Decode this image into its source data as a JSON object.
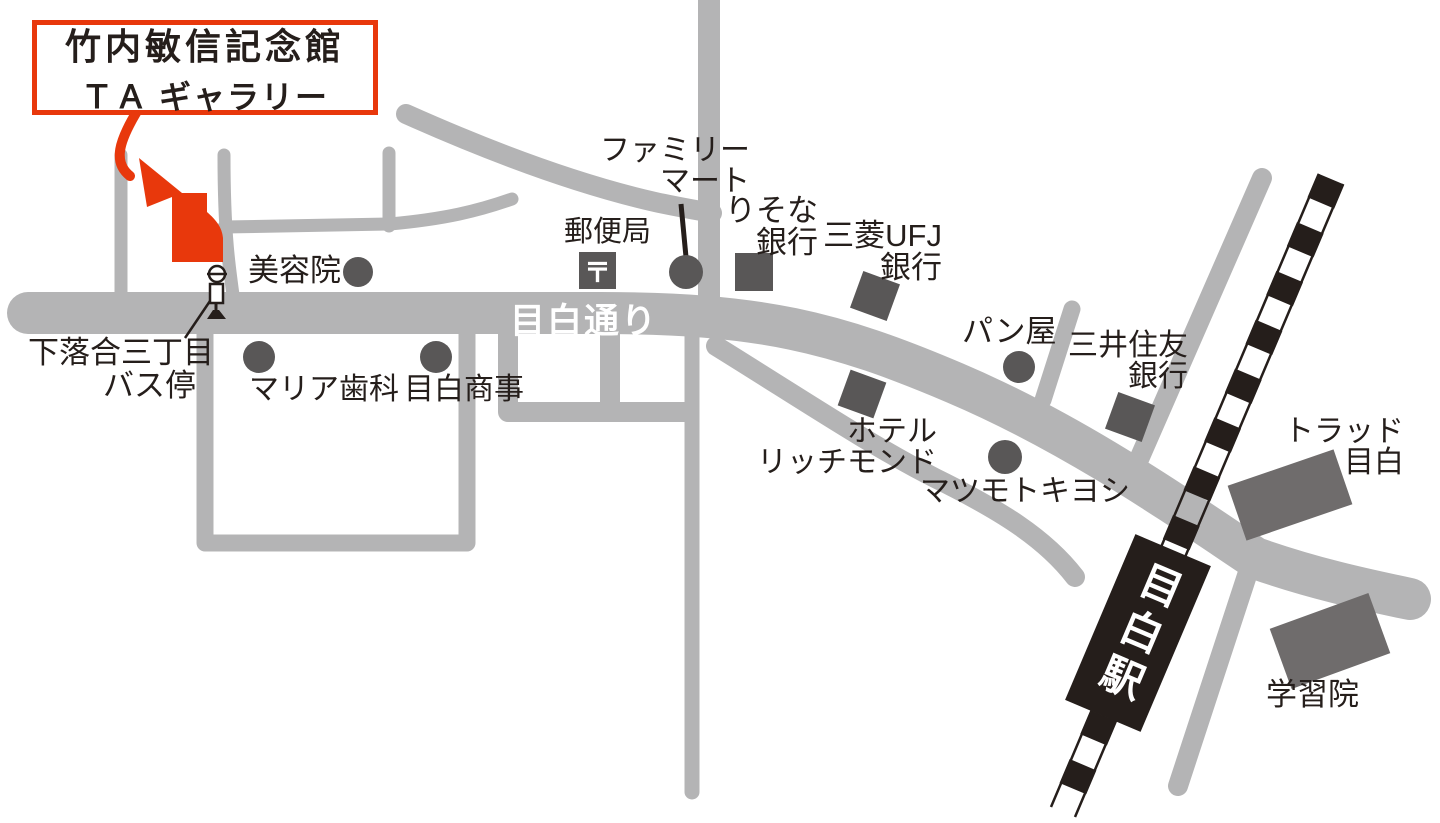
{
  "title_box": {
    "line1": "竹内敏信記念館",
    "line2": "ＴＡ ギャラリー"
  },
  "roads": {
    "main_road_label": "目白通り"
  },
  "railway": {
    "station_label": "目白駅"
  },
  "bus_stop": {
    "line1": "下落合三丁目",
    "line2": "バス停"
  },
  "landmarks": {
    "beauty_salon": {
      "label": "美容院"
    },
    "post_office": {
      "label": "郵便局",
      "mark": "〒"
    },
    "family_mart": {
      "line1": "ファミリー",
      "line2": "マート"
    },
    "resona_bank": {
      "line1": "りそな",
      "line2": "銀行"
    },
    "mufg_bank": {
      "line1": "三菱UFJ",
      "line2": "銀行"
    },
    "maria_dental": {
      "label": "マリア歯科"
    },
    "mejiro_shoji": {
      "label": "目白商事"
    },
    "bakery": {
      "label": "パン屋"
    },
    "smbc_bank": {
      "line1": "三井住友",
      "line2": "銀行"
    },
    "hotel_richmond": {
      "line1": "ホテル",
      "line2": "リッチモンド"
    },
    "matsumoto_kiyoshi": {
      "label": "マツモトキヨシ"
    },
    "trad_mejiro": {
      "line1": "トラッド",
      "line2": "目白"
    },
    "gakushuin": {
      "label": "学習院"
    }
  },
  "colors": {
    "accent_red": "#e8380c",
    "road_gray": "#b4b4b5",
    "marker_gray": "#595757",
    "building_gray": "#6f6c6c",
    "ink_black": "#251e1b"
  }
}
